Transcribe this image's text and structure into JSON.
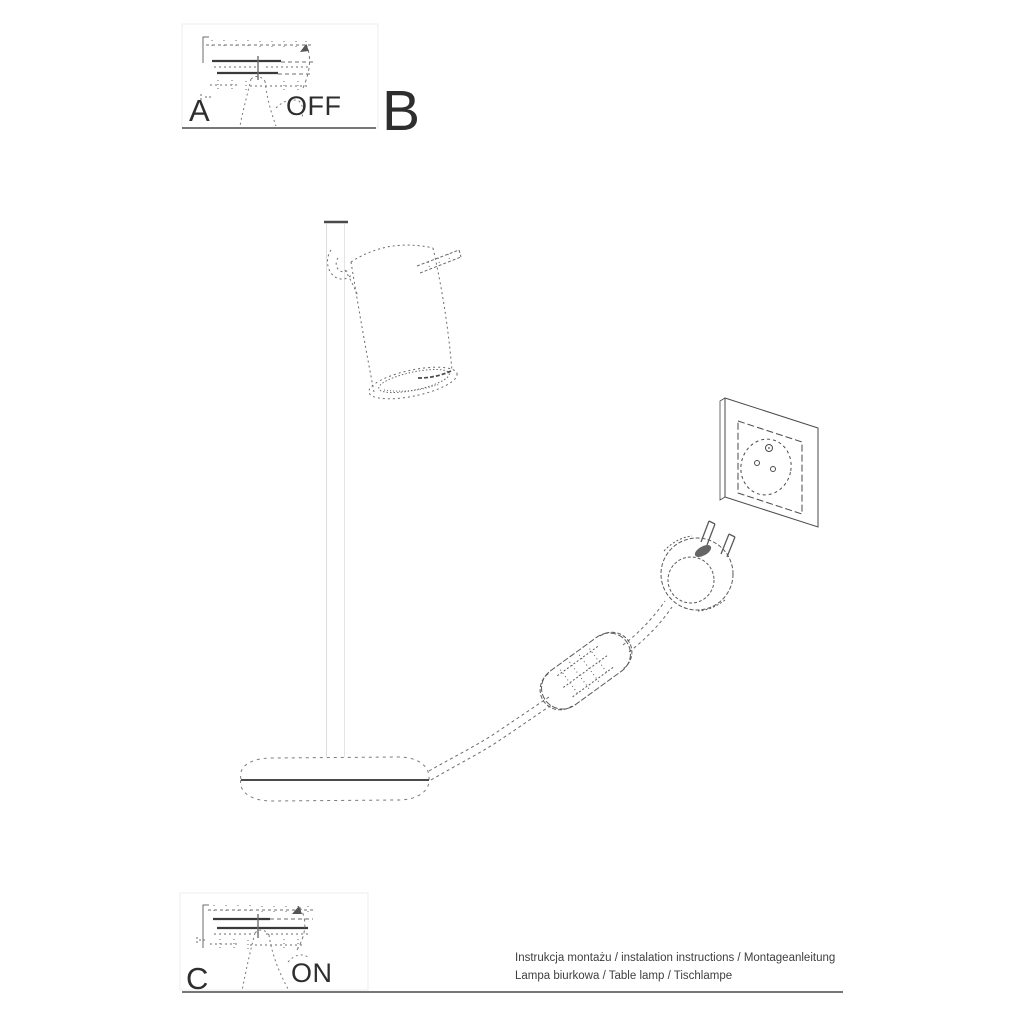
{
  "sheet": {
    "title_visible": false,
    "steps": {
      "a": {
        "label": "A",
        "caption": "OFF"
      },
      "b": {
        "label": "B"
      },
      "c": {
        "label": "C",
        "caption": "ON"
      }
    },
    "footer": {
      "line1": "Instrukcja montażu / instalation instructions / Montageanleitung",
      "line2": "Lampa biurkowa / Table lamp / Tischlampe"
    },
    "illustration": {
      "parts": [
        "lamp-shade",
        "shade-adjust-rod",
        "shade-pivot-joint",
        "lamp-pole",
        "lamp-base",
        "power-cord",
        "inline-cord-switch",
        "power-plug",
        "wall-socket",
        "pressing-finger",
        "press-direction-arrow"
      ]
    },
    "colors": {
      "paper": "#ffffff",
      "ink": "#3a3a3a",
      "sketch": "#6b6b6b",
      "faint_frame": "#ececec",
      "pole": "#d9d9d9",
      "rule": "#4a4a4a"
    }
  }
}
